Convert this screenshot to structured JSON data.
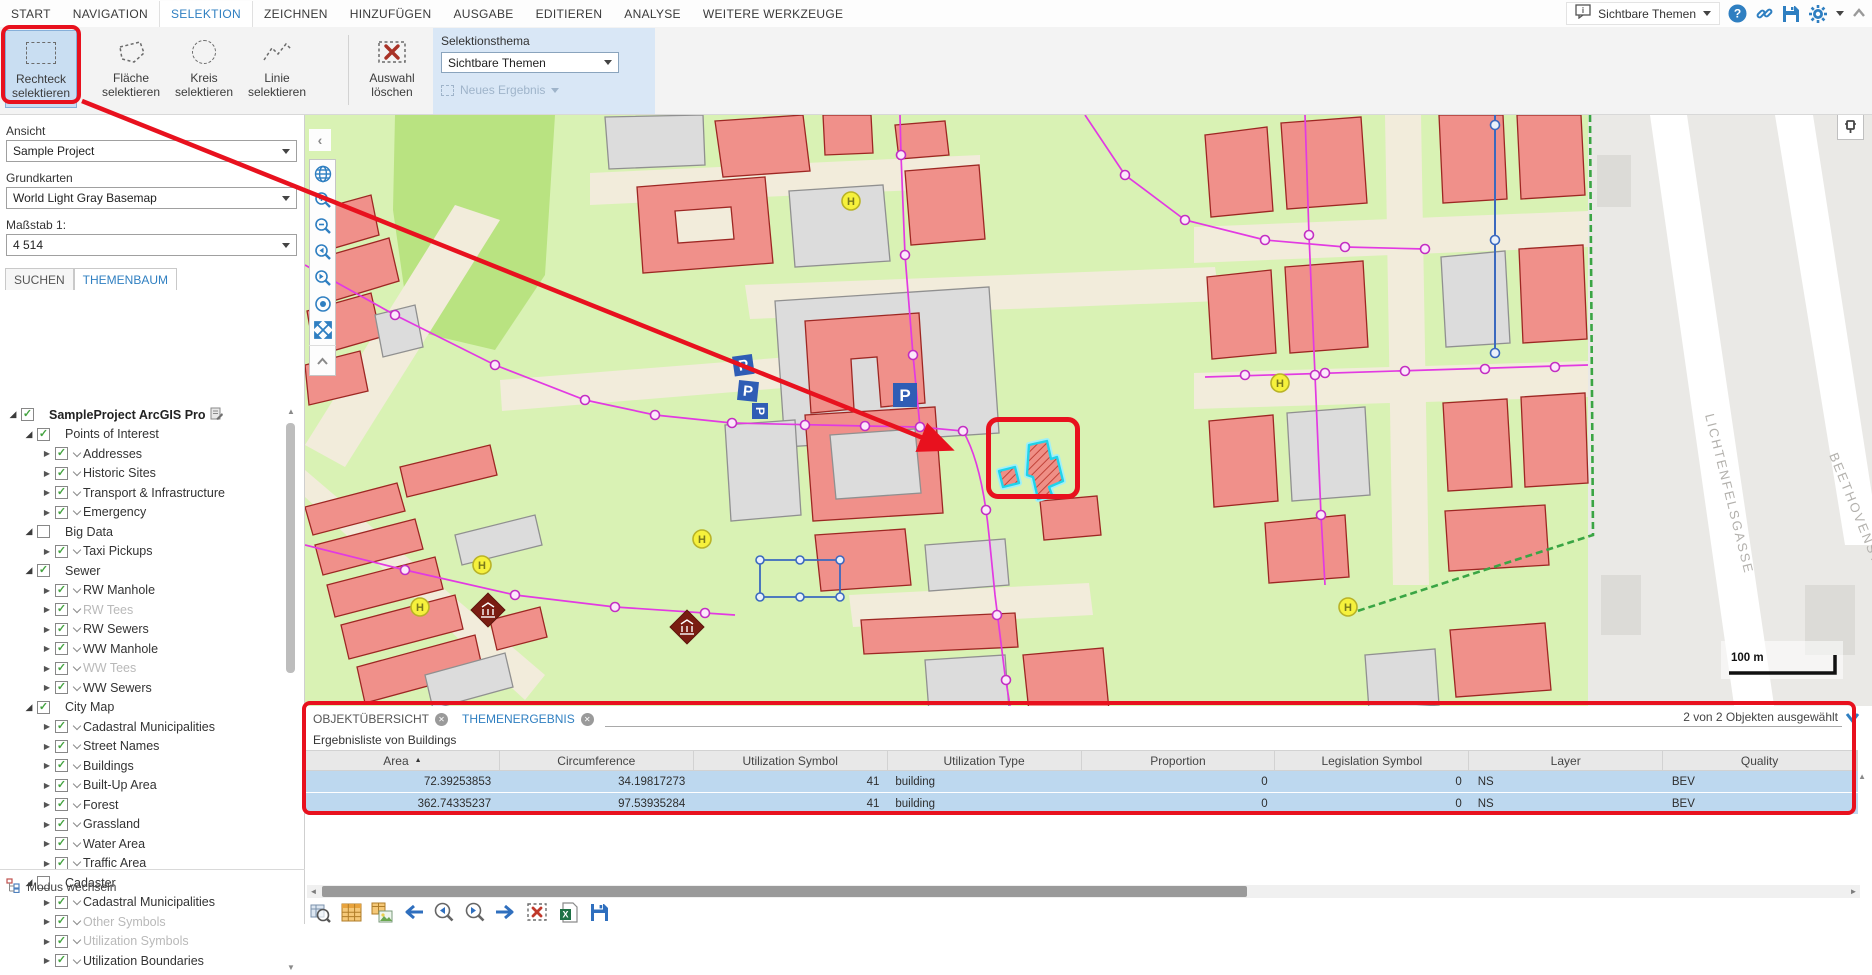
{
  "ribbon": {
    "tabs": [
      {
        "label": "START",
        "active": false
      },
      {
        "label": "NAVIGATION",
        "active": false
      },
      {
        "label": "SELEKTION",
        "active": true
      },
      {
        "label": "ZEICHNEN",
        "active": false
      },
      {
        "label": "HINZUFÜGEN",
        "active": false
      },
      {
        "label": "AUSGABE",
        "active": false
      },
      {
        "label": "EDITIEREN",
        "active": false
      },
      {
        "label": "ANALYSE",
        "active": false
      },
      {
        "label": "WEITERE WERKZEUGE",
        "active": false
      }
    ],
    "tools": [
      {
        "line1": "Rechteck",
        "line2": "selektieren"
      },
      {
        "line1": "Fläche",
        "line2": "selektieren"
      },
      {
        "line1": "Kreis",
        "line2": "selektieren"
      },
      {
        "line1": "Linie",
        "line2": "selektieren"
      },
      {
        "line1": "Auswahl",
        "line2": "löschen"
      }
    ],
    "selection_theme": {
      "label": "Selektionsthema",
      "value": "Sichtbare Themen",
      "new_result": "Neues Ergebnis"
    },
    "quick_theme_value": "Sichtbare Themen"
  },
  "left_panel": {
    "view_label": "Ansicht",
    "view_value": "Sample Project",
    "basemap_label": "Grundkarten",
    "basemap_value": "World Light Gray Basemap",
    "scale_label": "Maßstab 1:",
    "scale_value": "4 514",
    "tabs": [
      {
        "label": "SUCHEN",
        "active": false
      },
      {
        "label": "THEMENBAUM",
        "active": true
      }
    ],
    "tree": [
      {
        "level": 0,
        "label": "SampleProject ArcGIS Pro",
        "checked": true,
        "expand": "open",
        "bold": true,
        "root": true
      },
      {
        "level": 1,
        "label": "Points of Interest",
        "checked": true,
        "expand": "open"
      },
      {
        "level": 2,
        "label": "Addresses",
        "checked": true,
        "expand": "closed",
        "sub": true
      },
      {
        "level": 2,
        "label": "Historic Sites",
        "checked": true,
        "expand": "closed",
        "sub": true
      },
      {
        "level": 2,
        "label": "Transport & Infrastructure",
        "checked": true,
        "expand": "closed",
        "sub": true
      },
      {
        "level": 2,
        "label": "Emergency",
        "checked": true,
        "expand": "closed",
        "sub": true
      },
      {
        "level": 1,
        "label": "Big Data",
        "checked": false,
        "expand": "open"
      },
      {
        "level": 2,
        "label": "Taxi Pickups",
        "checked": true,
        "expand": "closed",
        "sub": true
      },
      {
        "level": 1,
        "label": "Sewer",
        "checked": true,
        "expand": "open"
      },
      {
        "level": 2,
        "label": "RW Manhole",
        "checked": true,
        "expand": "closed",
        "sub": true
      },
      {
        "level": 2,
        "label": "RW Tees",
        "checked": true,
        "expand": "closed",
        "sub": true,
        "gray": true
      },
      {
        "level": 2,
        "label": "RW Sewers",
        "checked": true,
        "expand": "closed",
        "sub": true
      },
      {
        "level": 2,
        "label": "WW Manhole",
        "checked": true,
        "expand": "closed",
        "sub": true
      },
      {
        "level": 2,
        "label": "WW Tees",
        "checked": true,
        "expand": "closed",
        "sub": true,
        "gray": true
      },
      {
        "level": 2,
        "label": "WW Sewers",
        "checked": true,
        "expand": "closed",
        "sub": true
      },
      {
        "level": 1,
        "label": "City Map",
        "checked": true,
        "expand": "open"
      },
      {
        "level": 2,
        "label": "Cadastral Municipalities",
        "checked": true,
        "expand": "closed",
        "sub": true
      },
      {
        "level": 2,
        "label": "Street Names",
        "checked": true,
        "expand": "closed",
        "sub": true
      },
      {
        "level": 2,
        "label": "Buildings",
        "checked": true,
        "expand": "closed",
        "sub": true
      },
      {
        "level": 2,
        "label": "Built-Up Area",
        "checked": true,
        "expand": "closed",
        "sub": true
      },
      {
        "level": 2,
        "label": "Forest",
        "checked": true,
        "expand": "closed",
        "sub": true
      },
      {
        "level": 2,
        "label": "Grassland",
        "checked": true,
        "expand": "closed",
        "sub": true
      },
      {
        "level": 2,
        "label": "Water Area",
        "checked": true,
        "expand": "closed",
        "sub": true
      },
      {
        "level": 2,
        "label": "Traffic Area",
        "checked": true,
        "expand": "closed",
        "sub": true
      },
      {
        "level": 1,
        "label": "Cadaster",
        "checked": false,
        "expand": "open"
      },
      {
        "level": 2,
        "label": "Cadastral Municipalities",
        "checked": true,
        "expand": "closed",
        "sub": true
      },
      {
        "level": 2,
        "label": "Other Symbols",
        "checked": true,
        "expand": "closed",
        "sub": true,
        "gray": true
      },
      {
        "level": 2,
        "label": "Utilization Symbols",
        "checked": true,
        "expand": "closed",
        "sub": true,
        "gray": true
      },
      {
        "level": 2,
        "label": "Utilization Boundaries",
        "checked": true,
        "expand": "closed",
        "sub": true
      }
    ],
    "mode_switch": "Modus wechseln"
  },
  "map": {
    "street_label_1": "LICHTENFELSGASSE",
    "street_label_2": "BEETHOVENSTR.",
    "scale_bar": "100 m",
    "parking_label": "P",
    "hydrant_label": "H"
  },
  "results": {
    "tabs": [
      {
        "label": "OBJEKTÜBERSICHT",
        "active": false
      },
      {
        "label": "THEMENERGEBNIS",
        "active": true
      }
    ],
    "status": "2 von 2 Objekten ausgewählt",
    "subtitle": "Ergebnisliste von Buildings",
    "columns": [
      {
        "label": "Area",
        "align": "right",
        "sorted": "asc"
      },
      {
        "label": "Circumference",
        "align": "right"
      },
      {
        "label": "Utilization Symbol",
        "align": "right"
      },
      {
        "label": "Utilization Type",
        "align": "left"
      },
      {
        "label": "Proportion",
        "align": "right"
      },
      {
        "label": "Legislation Symbol",
        "align": "right"
      },
      {
        "label": "Layer",
        "align": "left"
      },
      {
        "label": "Quality",
        "align": "left"
      }
    ],
    "rows": [
      [
        "72.39253853",
        "34.19817273",
        "41",
        "building",
        "0",
        "0",
        "NS",
        "BEV"
      ],
      [
        "362.74335237",
        "97.53935284",
        "41",
        "building",
        "0",
        "0",
        "NS",
        "BEV"
      ]
    ]
  },
  "colors": {
    "accent_blue": "#2f7fc1",
    "annotation_red": "#e8111e",
    "selection_row": "#bdd8ef",
    "building_fill": "#f0908a",
    "building_stroke": "#9d2723",
    "grass": "#d9f2b4",
    "magenta_line": "#e23ae2",
    "selected_feature_cyan": "#2fdcf0"
  }
}
